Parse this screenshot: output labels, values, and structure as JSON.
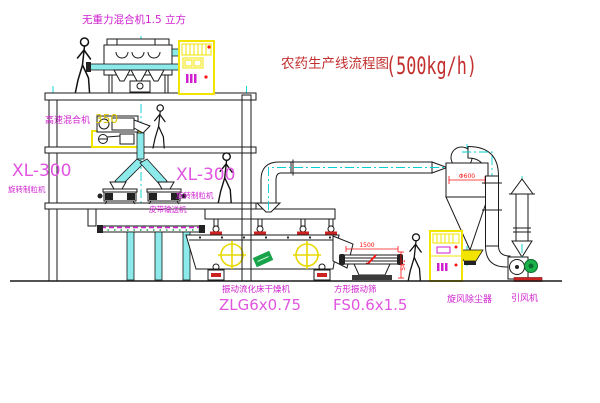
{
  "diagram": {
    "title": {
      "text": "农药生产线流程图",
      "capacity": "(500kg/h)"
    },
    "colors": {
      "label_magenta": "#cf1fcf",
      "model_magenta": "#e054e0",
      "title_red": "#c22f2f",
      "dim_red": "#ff1111",
      "accent_yellow": "#f2e400",
      "accent_cyan": "#00cfcf",
      "fan_green": "#19b24b",
      "size_yellow": "#d8c400"
    },
    "equipment": {
      "gravity_mixer": {
        "label": "无重力混合机1.5 立方"
      },
      "high_speed_mixer": {
        "label": "高速混合机",
        "size": "350"
      },
      "granulator_left": {
        "model": "XL-300",
        "label": "旋转制粒机"
      },
      "granulator_right": {
        "model": "XL-300",
        "label": "旋转制粒机"
      },
      "belt_conveyor": {
        "label": "皮带输送机"
      },
      "fluid_bed_dryer": {
        "label": "振动流化床干燥机",
        "model": "ZLG6x0.75"
      },
      "vibrating_sieve": {
        "label": "方形振动筛",
        "model": "FS0.6x1.5",
        "dim_length": "1500",
        "dim_height": "541"
      },
      "cyclone": {
        "label": "旋风除尘器",
        "dim_diameter": "Φ600"
      },
      "induced_draft_fan": {
        "label": "引风机"
      }
    }
  }
}
